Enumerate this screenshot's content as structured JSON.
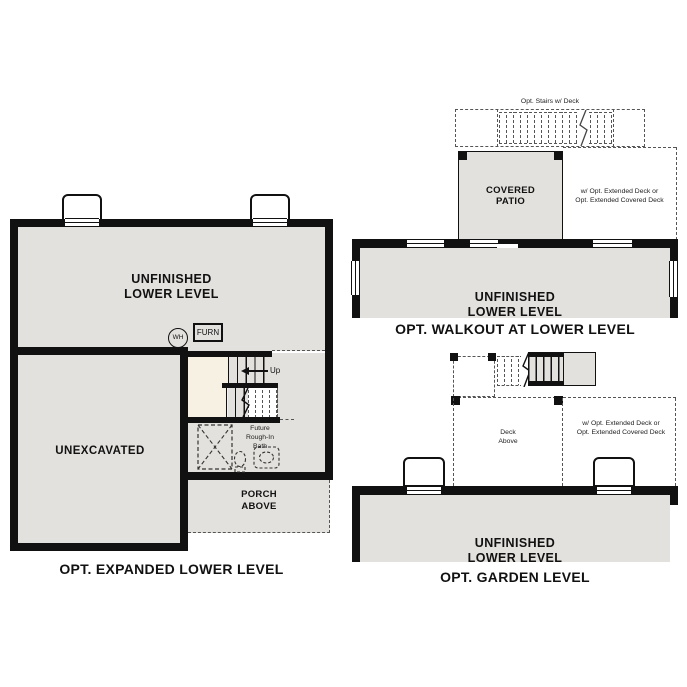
{
  "sheet": {
    "background": "#ffffff"
  },
  "colors": {
    "wall": "#111111",
    "room_fill": "#e3e1dd",
    "stair_landing_fill": "#f7f1e3",
    "dashed_line": "#555555",
    "text": "#111111"
  },
  "expanded": {
    "title": "OPT. EXPANDED LOWER LEVEL",
    "room_line1": "UNFINISHED",
    "room_line2": "LOWER LEVEL",
    "unexcavated_label": "UNEXCAVATED",
    "water_heater_label": "WH",
    "furnace_label": "FURN",
    "up_label": "Up",
    "bath_line1": "Future",
    "bath_line2": "Rough-In",
    "bath_line3": "Bath",
    "porch_line1": "PORCH",
    "porch_line2": "ABOVE"
  },
  "walkout": {
    "title": "OPT. WALKOUT AT LOWER LEVEL",
    "stairs_label": "Opt. Stairs w/ Deck",
    "patio_line1": "COVERED",
    "patio_line2": "PATIO",
    "deck_option_line1": "w/ Opt. Extended Deck or",
    "deck_option_line2": "Opt. Extended Covered Deck",
    "room_line1": "UNFINISHED",
    "room_line2": "LOWER LEVEL"
  },
  "garden": {
    "title": "OPT. GARDEN LEVEL",
    "deck_above_line1": "Deck",
    "deck_above_line2": "Above",
    "deck_option_line1": "w/ Opt. Extended Deck or",
    "deck_option_line2": "Opt. Extended Covered Deck",
    "room_line1": "UNFINISHED",
    "room_line2": "LOWER LEVEL"
  }
}
